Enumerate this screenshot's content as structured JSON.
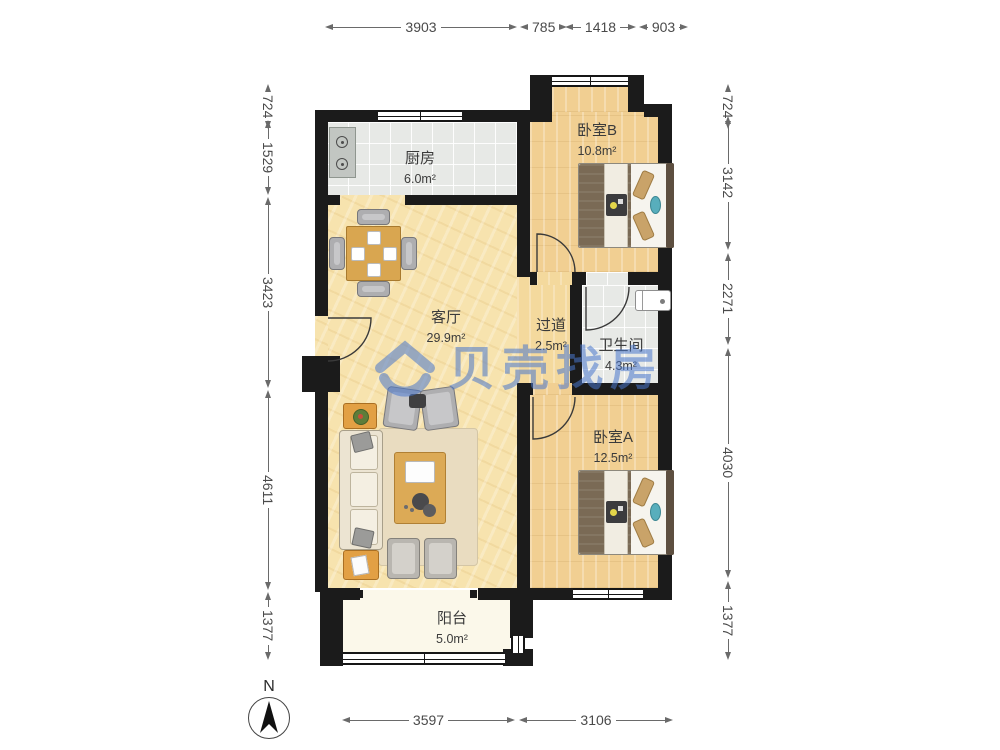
{
  "watermark": {
    "brand": "贝壳找房"
  },
  "compass": {
    "north_label": "N"
  },
  "rooms": [
    {
      "name": "厨房",
      "area": "6.0m²"
    },
    {
      "name": "卧室B",
      "area": "10.8m²"
    },
    {
      "name": "客厅",
      "area": "29.9m²"
    },
    {
      "name": "过道",
      "area": "2.5m²"
    },
    {
      "name": "卫生间",
      "area": "4.3m²"
    },
    {
      "name": "卧室A",
      "area": "12.5m²"
    },
    {
      "name": "阳台",
      "area": "5.0m²"
    }
  ],
  "dimensions": {
    "top": [
      "3903",
      "785",
      "1418",
      "903"
    ],
    "bottom": [
      "3597",
      "3106"
    ],
    "left": [
      "724",
      "1529",
      "3423",
      "4611",
      "1377"
    ],
    "right": [
      "724",
      "3142",
      "2271",
      "4030",
      "1377"
    ]
  },
  "colors": {
    "wall": "#1b1b1b",
    "wood_living": "#f7e3ae",
    "wood_bedroom": "#f1cf92",
    "tile": "#e7e9e6",
    "balcony": "#fbf8ea",
    "watermark_blue": "#4876cc"
  }
}
